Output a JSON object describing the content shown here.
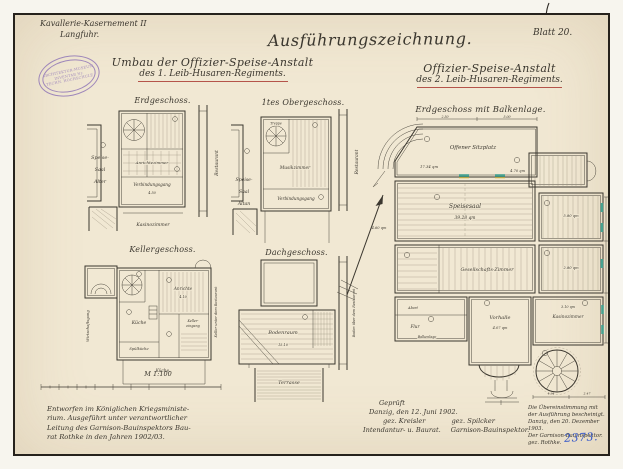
{
  "colors": {
    "paper": "#f1e8d3",
    "ink": "#3b372f",
    "red_underline": "#b5544a",
    "teal_window": "#46a190",
    "yellow_mark": "#d8c14e",
    "blue_number": "#3356c9",
    "stamp_purple": "#8a6fb5"
  },
  "header": {
    "corner": [
      "Kavallerie-Kasernement II",
      "Langfuhr."
    ],
    "stamp": [
      "ARCHITEKTUR-MUSEUM",
      "INVENTAR Nr.",
      "TECHN. HOCHSCHULE"
    ],
    "main_title": "Ausführungszeichnung.",
    "left_title": [
      "Umbau der Offizier-Speise-Anstalt",
      "des 1. Leib-Husaren-Regiments."
    ],
    "right_title": [
      "Offizier-Speise-Anstalt",
      "des 2. Leib-Husaren-Regiments."
    ],
    "sheet_no": "Blatt 20."
  },
  "plans": {
    "erdgeschoss": {
      "title": "Erdgeschoss.",
      "left_labels": [
        "Speise-",
        "Saal",
        "Alter"
      ],
      "rooms": {
        "anrichte": "Anrichtezimmer",
        "gang": "Verbindungsgang",
        "kasino": "Kasinozimmer",
        "restaurant": "Restaurant"
      },
      "dims": [
        "4.50"
      ]
    },
    "obergeschoss": {
      "title": "1tes Obergeschoss.",
      "left_labels": [
        "Speise-",
        "Saal",
        "Altan"
      ],
      "rooms": {
        "treppe": "Treppe",
        "musik": "Musikzimmer",
        "gang": "Verbindungsgang",
        "restaurant": "Restaurant"
      }
    },
    "keller": {
      "title": "Kellergeschoss.",
      "rooms": {
        "kueche": "Küche",
        "anrichte": "Anrichte",
        "spuel": "Spülküche",
        "gang": "Wirtschaftsgang",
        "eingang": [
          "Keller-",
          "eingang"
        ],
        "rechts": "Keller unter dem Restaurant",
        "unten": "Küche."
      },
      "dims": [
        "4.10"
      ]
    },
    "dach": {
      "title": "Dachgeschoss.",
      "rooms": {
        "boden": "Bodenraum",
        "terrasse": "Terrasse",
        "rechts": "Boden über dem Restaurant"
      },
      "dims": [
        "15.10"
      ]
    },
    "balkenlage": {
      "title": "Erdgeschoss mit Balkenlage.",
      "rooms": {
        "sitzplatz": "Offener Sitzplatz",
        "speisesaal": "Speisesaal",
        "gesellschaft": "Gesellschafts-Zimmer",
        "vorhalle": "Vorhalle",
        "kasino": "Kasinozimmer",
        "flur": "Flur",
        "abort": "Abort",
        "balkenlage": "Balkenlage"
      },
      "dims": {
        "sitzplatz": "17.34 qm",
        "speisesaal": "39.28 qm",
        "landing": "4.70 qm",
        "r1": "5.80 qm",
        "r2": "2.80 qm",
        "vorhalle": "4.07 qm",
        "kasino": "3.10 qm",
        "left": "4.60 qm",
        "top1": "2.50",
        "top2": "5.00",
        "bottom1": "4.94",
        "bottom2": "2.47"
      }
    }
  },
  "scale": {
    "label": "M 1:100"
  },
  "notes_left": [
    "Entworfen im Königlichen Kriegsministe-",
    "rium. Ausgeführt unter verantwortlicher",
    "Leitung des Garnison-Bauinspektors Bau-",
    "rat Rothke in den Jahren 1902/03."
  ],
  "approval": {
    "checked": "Geprüft",
    "place_date": "Danzig, den 12. Juni 1902.",
    "sig_left": "gez. Kreisler",
    "sig_right": "gez. Spilcker",
    "role_left": "Intendantur- u. Baurat.",
    "role_right": "Garnison-Bauinspektor."
  },
  "certification": {
    "lines": [
      "Die Übereinstimmung mit",
      "der Ausführung bescheinigt.",
      "Danzig, den 20. Dezember 1903.",
      "Der Garnison-Bauinspektor.",
      "gez. Rothke."
    ]
  },
  "archive_no": "2373."
}
